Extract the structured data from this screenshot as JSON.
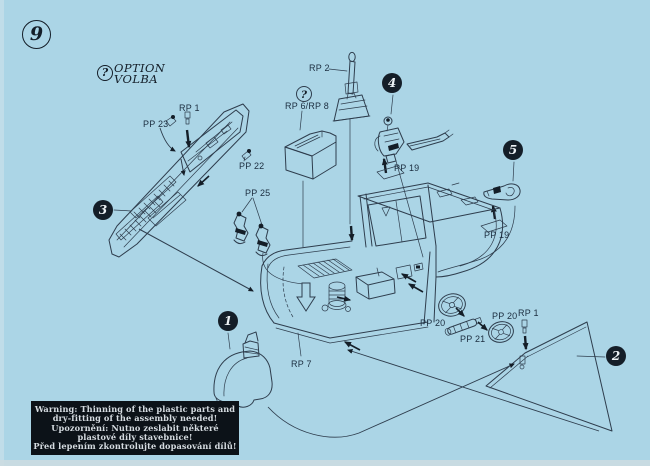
{
  "colors": {
    "background": "#abd5e6",
    "line": "#2e3d4d",
    "ink": "#141e28",
    "label": "#1b2d3f",
    "warning-bg": "#0c1218",
    "warning-text": "#d6dce1",
    "disc-text": "#edf2f5"
  },
  "step_badge": {
    "number": "9"
  },
  "symbols": {
    "question": "?"
  },
  "option_legend": {
    "line1": "OPTION",
    "line2": "VOLBA"
  },
  "steps": {
    "s1": "1",
    "s2": "2",
    "s3": "3",
    "s4": "4",
    "s5": "5"
  },
  "part_labels": {
    "rp1_top": "RP 1",
    "pp23": "PP 23",
    "pp22": "PP 22",
    "pp25": "PP 25",
    "rp2": "RP 2",
    "rp6_rp8": "RP 6/RP 8",
    "pp19_upper": "PP 19",
    "pp19_right": "PP 19",
    "rp7": "RP 7",
    "pp20_left": "PP 20",
    "pp21": "PP 21",
    "pp20_right": "PP 20",
    "rp1_right": "RP 1"
  },
  "warning": {
    "line1": "Warning: Thinning of the plastic parts and",
    "line2": "dry-fitting of the assembly needed!",
    "line3": "Upozornění: Nutno zeslabit některé plastové díly stavebnice!",
    "line4": "Před lepením zkontrolujte dopasování dílů!"
  }
}
